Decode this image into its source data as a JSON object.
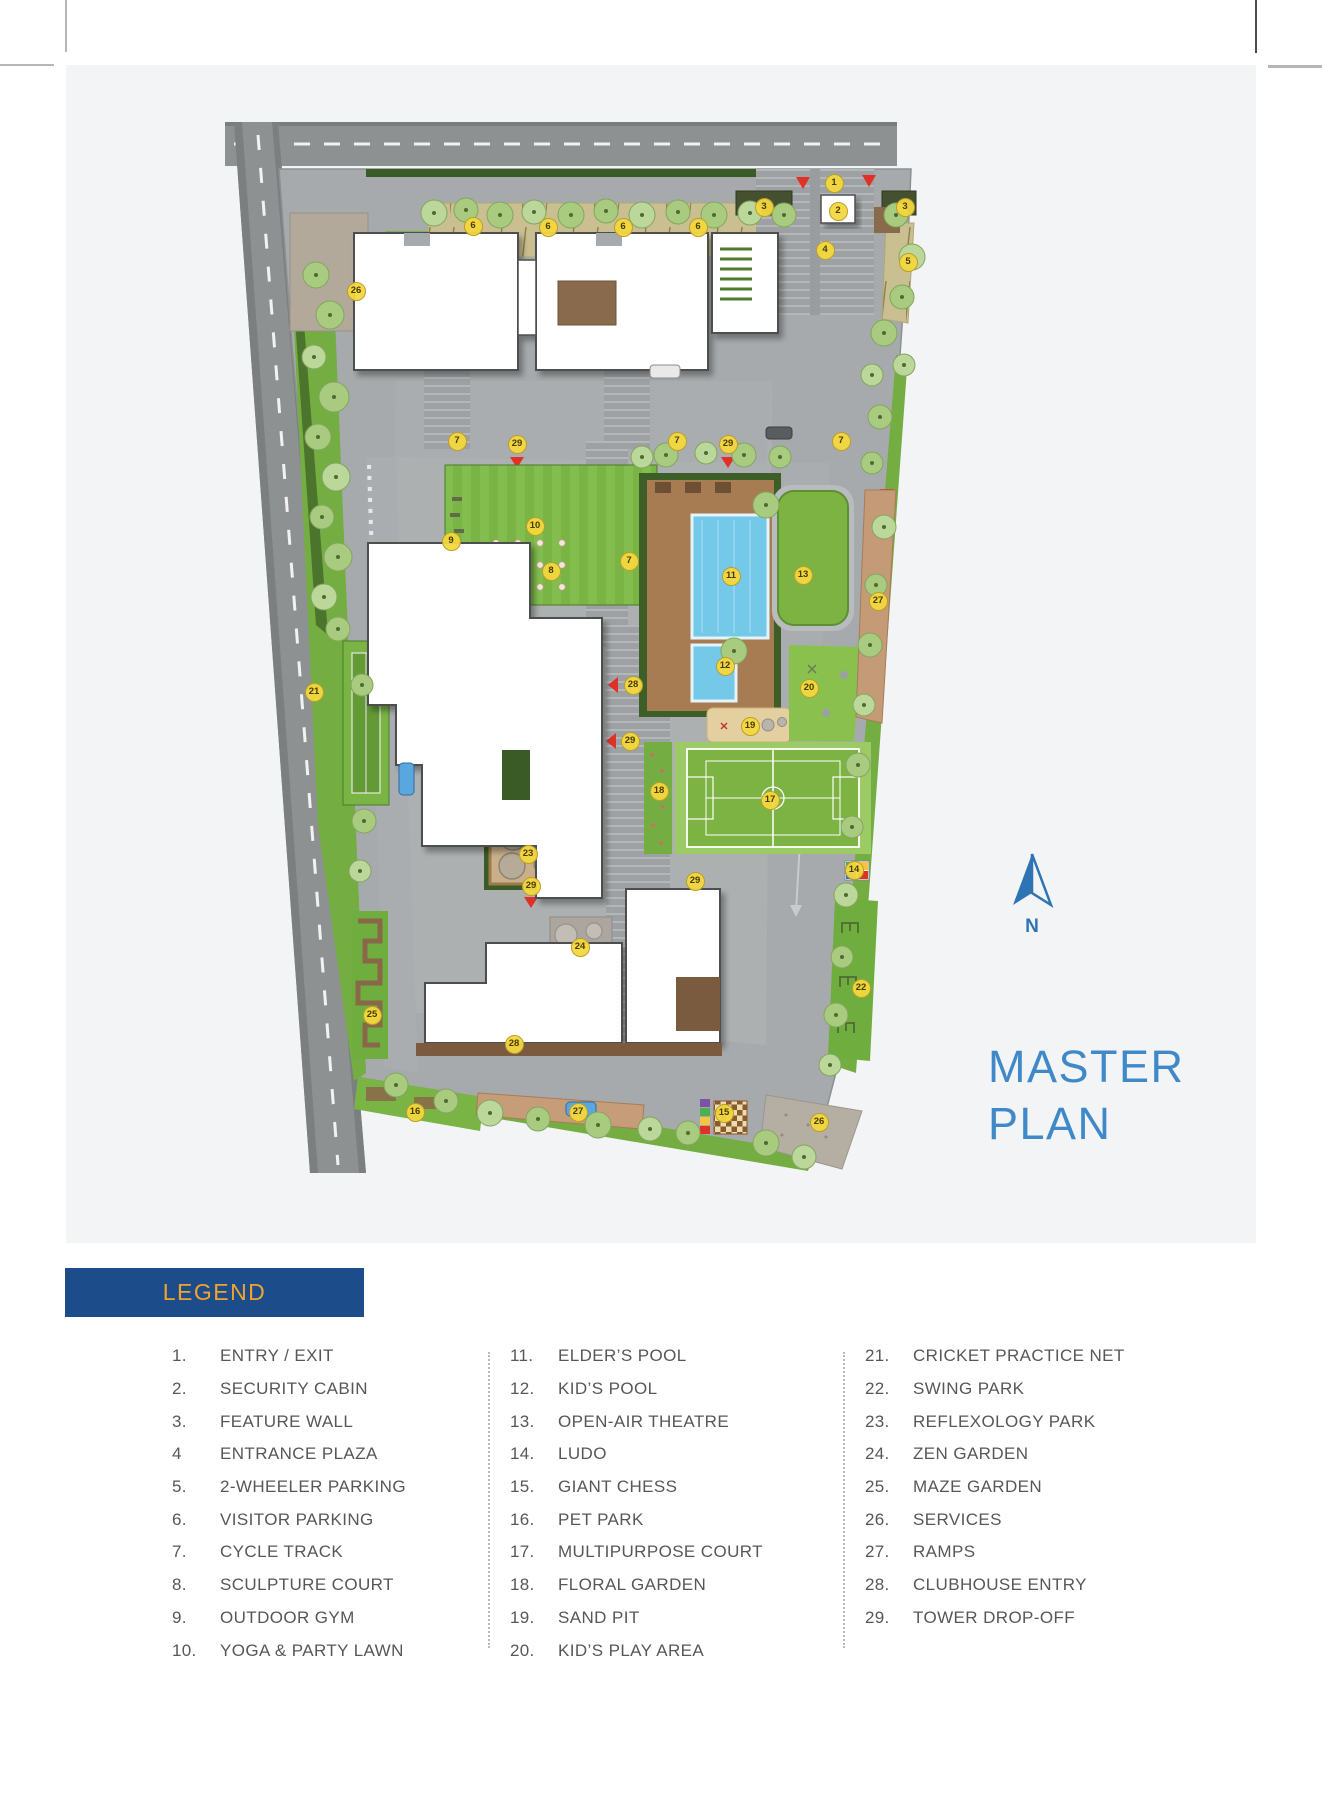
{
  "title": {
    "line1": "MASTER",
    "line2": "PLAN",
    "color": "#4089c8"
  },
  "compass": {
    "label": "N",
    "color": "#2e74b5"
  },
  "legend": {
    "title": "LEGEND",
    "bar_color": "#1c4c8a",
    "title_color": "#f0a32f",
    "text_color": "#55575b",
    "columns": [
      [
        {
          "n": "1.",
          "label": "ENTRY / EXIT"
        },
        {
          "n": "2.",
          "label": "SECURITY CABIN"
        },
        {
          "n": "3.",
          "label": "FEATURE WALL"
        },
        {
          "n": "4",
          "label": "ENTRANCE PLAZA"
        },
        {
          "n": "5.",
          "label": "2-WHEELER PARKING"
        },
        {
          "n": "6.",
          "label": "VISITOR PARKING"
        },
        {
          "n": "7.",
          "label": "CYCLE TRACK"
        },
        {
          "n": "8.",
          "label": "SCULPTURE COURT"
        },
        {
          "n": "9.",
          "label": "OUTDOOR GYM"
        },
        {
          "n": "10.",
          "label": "YOGA & PARTY LAWN"
        }
      ],
      [
        {
          "n": "11.",
          "label": "ELDER’S POOL"
        },
        {
          "n": "12.",
          "label": "KID’S POOL"
        },
        {
          "n": "13.",
          "label": "OPEN-AIR THEATRE"
        },
        {
          "n": "14.",
          "label": "LUDO"
        },
        {
          "n": "15.",
          "label": "GIANT CHESS"
        },
        {
          "n": "16.",
          "label": "PET PARK"
        },
        {
          "n": "17.",
          "label": "MULTIPURPOSE COURT"
        },
        {
          "n": "18.",
          "label": "FLORAL GARDEN"
        },
        {
          "n": "19.",
          "label": "SAND PIT"
        },
        {
          "n": "20.",
          "label": "KID’S PLAY AREA"
        }
      ],
      [
        {
          "n": "21.",
          "label": "CRICKET PRACTICE NET"
        },
        {
          "n": "22.",
          "label": "SWING PARK"
        },
        {
          "n": "23.",
          "label": "REFLEXOLOGY PARK"
        },
        {
          "n": "24.",
          "label": "ZEN GARDEN"
        },
        {
          "n": "25.",
          "label": "MAZE GARDEN"
        },
        {
          "n": "26.",
          "label": "SERVICES"
        },
        {
          "n": "27.",
          "label": "RAMPS"
        },
        {
          "n": "28.",
          "label": "CLUBHOUSE ENTRY"
        },
        {
          "n": "29.",
          "label": "TOWER DROP-OFF"
        }
      ]
    ]
  },
  "plan": {
    "marker_color": "#f3d73e",
    "markers": [
      {
        "n": "1",
        "x": 767,
        "y": 117
      },
      {
        "n": "2",
        "x": 771,
        "y": 145
      },
      {
        "n": "3",
        "x": 697,
        "y": 141
      },
      {
        "n": "3",
        "x": 838,
        "y": 141
      },
      {
        "n": "4",
        "x": 758,
        "y": 184
      },
      {
        "n": "5",
        "x": 841,
        "y": 196
      },
      {
        "n": "6",
        "x": 406,
        "y": 160
      },
      {
        "n": "6",
        "x": 481,
        "y": 161
      },
      {
        "n": "6",
        "x": 556,
        "y": 161
      },
      {
        "n": "6",
        "x": 631,
        "y": 161
      },
      {
        "n": "7",
        "x": 390,
        "y": 375
      },
      {
        "n": "7",
        "x": 610,
        "y": 375
      },
      {
        "n": "7",
        "x": 774,
        "y": 375
      },
      {
        "n": "7",
        "x": 562,
        "y": 495
      },
      {
        "n": "8",
        "x": 484,
        "y": 505
      },
      {
        "n": "9",
        "x": 384,
        "y": 475
      },
      {
        "n": "10",
        "x": 468,
        "y": 460
      },
      {
        "n": "11",
        "x": 664,
        "y": 510
      },
      {
        "n": "12",
        "x": 658,
        "y": 600
      },
      {
        "n": "13",
        "x": 736,
        "y": 509
      },
      {
        "n": "14",
        "x": 787,
        "y": 804
      },
      {
        "n": "15",
        "x": 657,
        "y": 1047
      },
      {
        "n": "16",
        "x": 348,
        "y": 1046
      },
      {
        "n": "17",
        "x": 703,
        "y": 734
      },
      {
        "n": "18",
        "x": 592,
        "y": 725
      },
      {
        "n": "19",
        "x": 683,
        "y": 660
      },
      {
        "n": "20",
        "x": 742,
        "y": 622
      },
      {
        "n": "21",
        "x": 247,
        "y": 626
      },
      {
        "n": "22",
        "x": 794,
        "y": 922
      },
      {
        "n": "23",
        "x": 461,
        "y": 788
      },
      {
        "n": "24",
        "x": 513,
        "y": 881
      },
      {
        "n": "25",
        "x": 305,
        "y": 949
      },
      {
        "n": "26",
        "x": 289,
        "y": 225
      },
      {
        "n": "26",
        "x": 752,
        "y": 1056
      },
      {
        "n": "27",
        "x": 811,
        "y": 535
      },
      {
        "n": "27",
        "x": 511,
        "y": 1046
      },
      {
        "n": "28",
        "x": 566,
        "y": 619
      },
      {
        "n": "28",
        "x": 447,
        "y": 978
      },
      {
        "n": "29",
        "x": 450,
        "y": 378
      },
      {
        "n": "29",
        "x": 661,
        "y": 378
      },
      {
        "n": "29",
        "x": 563,
        "y": 675
      },
      {
        "n": "29",
        "x": 464,
        "y": 820
      },
      {
        "n": "29",
        "x": 628,
        "y": 815
      }
    ]
  }
}
